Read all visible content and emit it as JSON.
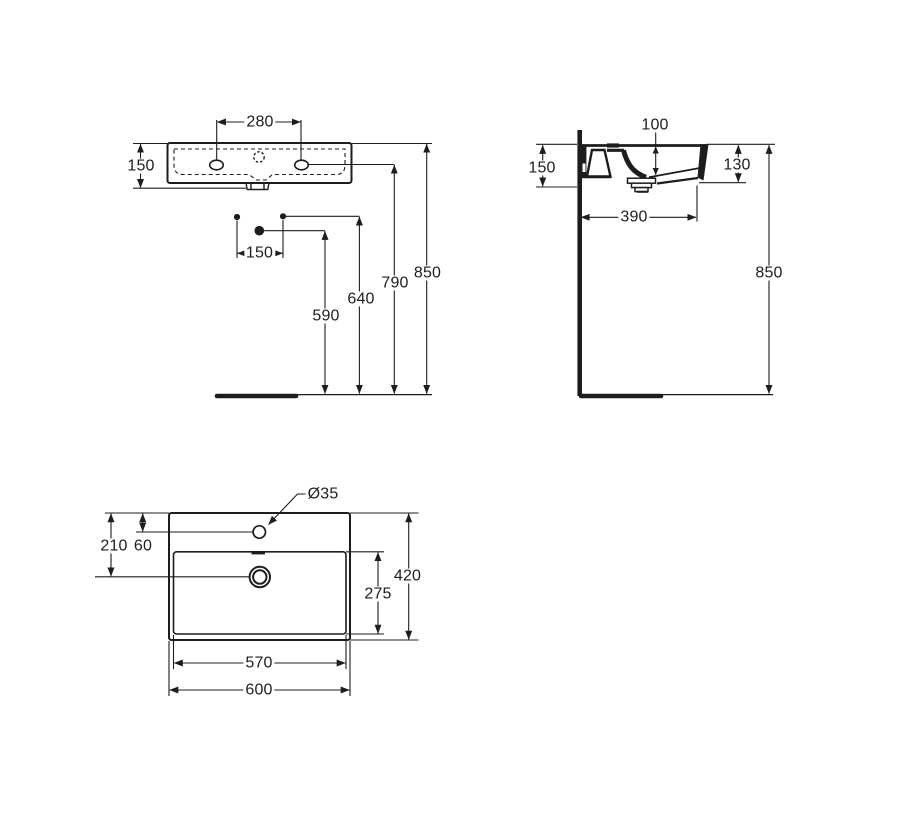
{
  "colors": {
    "background": "#ffffff",
    "line": "#1d1d1d"
  },
  "views": {
    "front": {
      "dims": {
        "tap_hole_spacing": "280",
        "basin_height": "150",
        "connection_spacing": "150",
        "waste_outlet_height": "590",
        "connections_height": "640",
        "tap_hole_height": "790",
        "rim_height": "850"
      }
    },
    "side": {
      "dims": {
        "bowl_depth": "100",
        "rear_edge_height": "150",
        "front_edge_height": "130",
        "underside_depth": "390",
        "rim_height": "850"
      }
    },
    "plan": {
      "dims": {
        "tap_hole_diameter": "Ø35",
        "waste_center_from_rear": "210",
        "tap_hole_from_rear": "60",
        "overall_depth": "420",
        "bowl_depth": "275",
        "bowl_width": "570",
        "overall_width": "600"
      }
    }
  }
}
